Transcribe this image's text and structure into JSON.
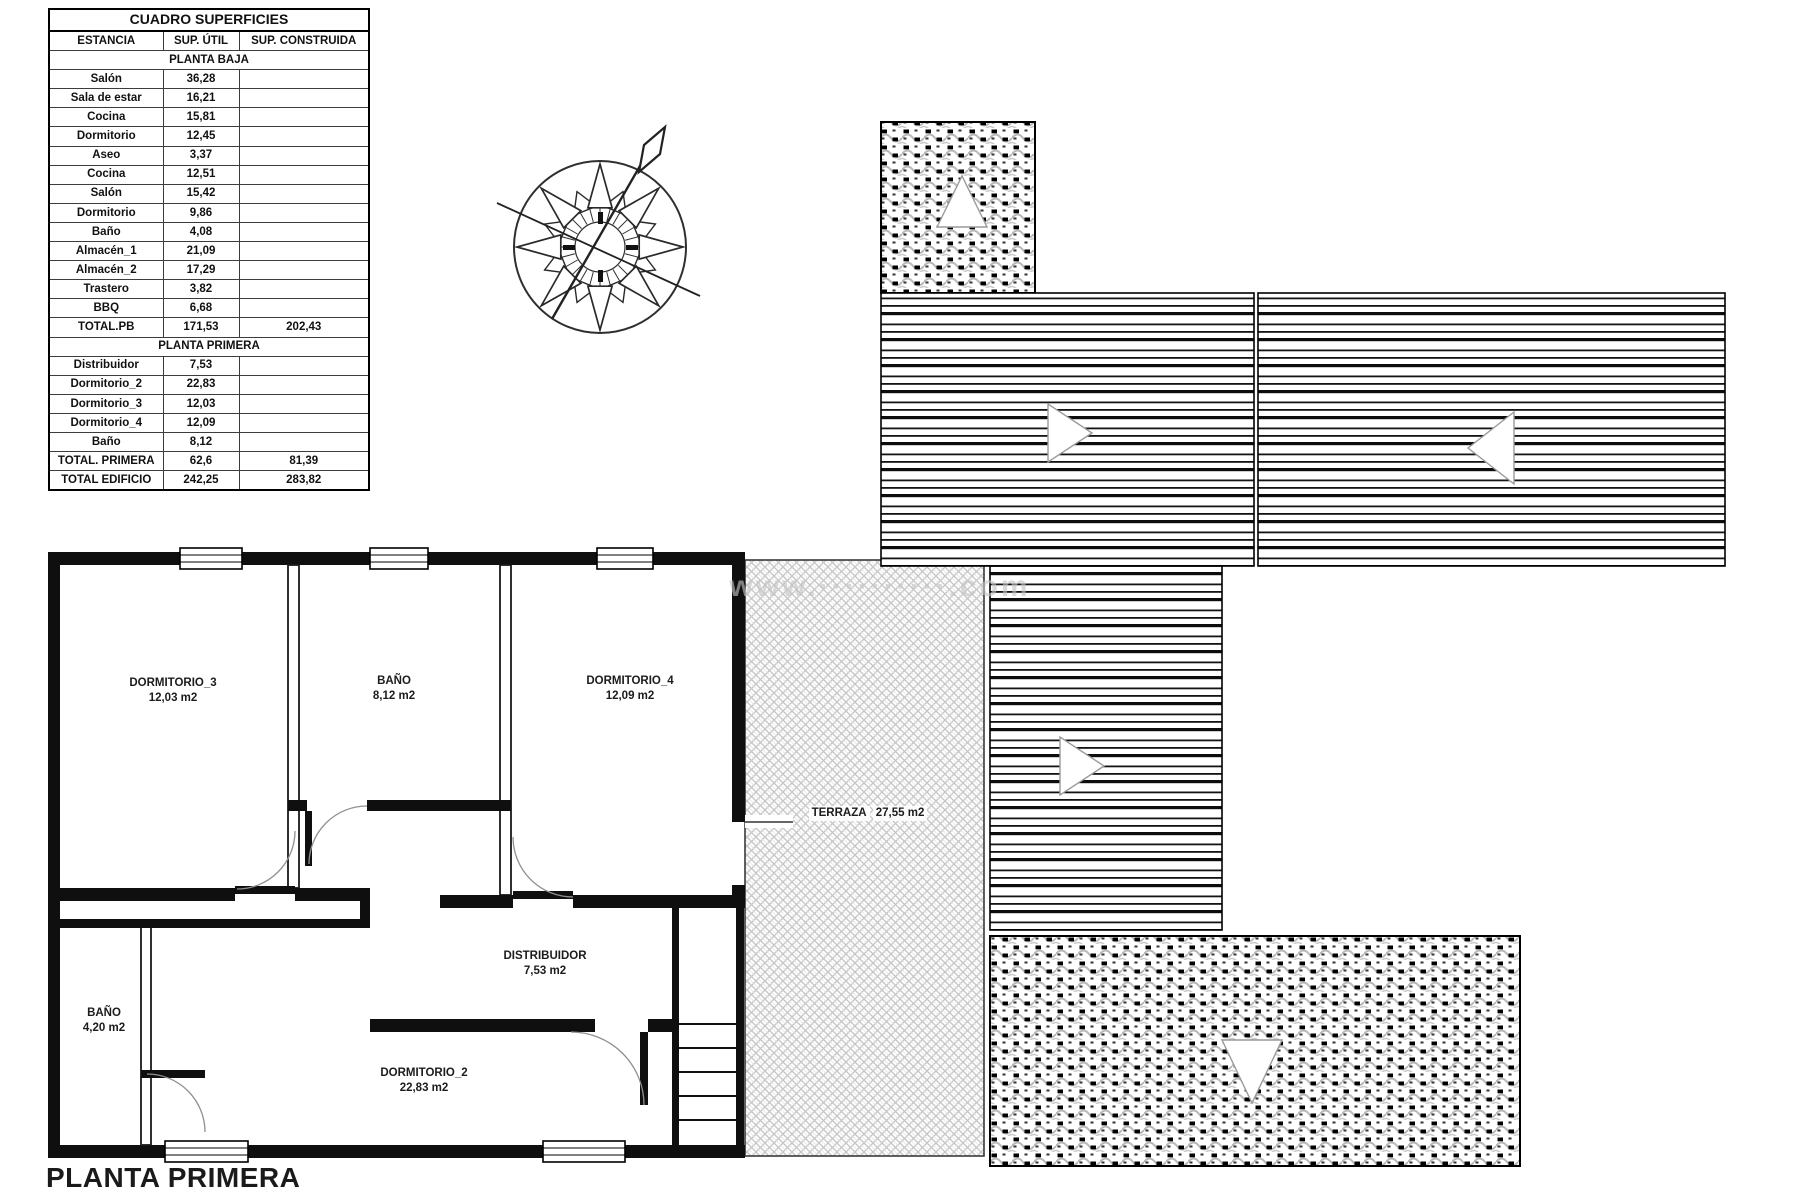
{
  "surface_table": {
    "title": "CUADRO SUPERFICIES",
    "headers": [
      "ESTANCIA",
      "SUP. ÚTIL",
      "SUP. CONSTRUIDA"
    ],
    "sections": [
      {
        "name": "PLANTA BAJA",
        "rows": [
          [
            "Salón",
            "36,28"
          ],
          [
            "Sala de estar",
            "16,21"
          ],
          [
            "Cocina",
            "15,81"
          ],
          [
            "Dormitorio",
            "12,45"
          ],
          [
            "Aseo",
            "3,37"
          ],
          [
            "Cocina",
            "12,51"
          ],
          [
            "Salón",
            "15,42"
          ],
          [
            "Dormitorio",
            "9,86"
          ],
          [
            "Baño",
            "4,08"
          ],
          [
            "Almacén_1",
            "21,09"
          ],
          [
            "Almacén_2",
            "17,29"
          ],
          [
            "Trastero",
            "3,82"
          ],
          [
            "BBQ",
            "6,68"
          ]
        ],
        "total": [
          "TOTAL.PB",
          "171,53",
          "202,43"
        ]
      },
      {
        "name": "PLANTA PRIMERA",
        "rows": [
          [
            "Distribuidor",
            "7,53"
          ],
          [
            "Dormitorio_2",
            "22,83"
          ],
          [
            "Dormitorio_3",
            "12,03"
          ],
          [
            "Dormitorio_4",
            "12,09"
          ],
          [
            "Baño",
            "8,12"
          ]
        ],
        "total": [
          "TOTAL. PRIMERA",
          "62,6",
          "81,39"
        ]
      }
    ],
    "grand_total": [
      "TOTAL EDIFICIO",
      "242,25",
      "283,82"
    ]
  },
  "plan": {
    "title": "PLANTA PRIMERA",
    "watermark": "www.··········.com",
    "rooms": {
      "dormitorio_3": {
        "name": "DORMITORIO_3",
        "area": "12,03 m2"
      },
      "bano_p1": {
        "name": "BAÑO",
        "area": "8,12 m2"
      },
      "dormitorio_4": {
        "name": "DORMITORIO_4",
        "area": "12,09 m2"
      },
      "distribuidor": {
        "name": "DISTRIBUIDOR",
        "area": "7,53 m2"
      },
      "bano_small": {
        "name": "BAÑO",
        "area": "4,20 m2"
      },
      "dormitorio_2": {
        "name": "DORMITORIO_2",
        "area": "22,83 m2"
      },
      "terraza": {
        "name": "TERRAZA",
        "area": "27,55 m2"
      }
    }
  }
}
